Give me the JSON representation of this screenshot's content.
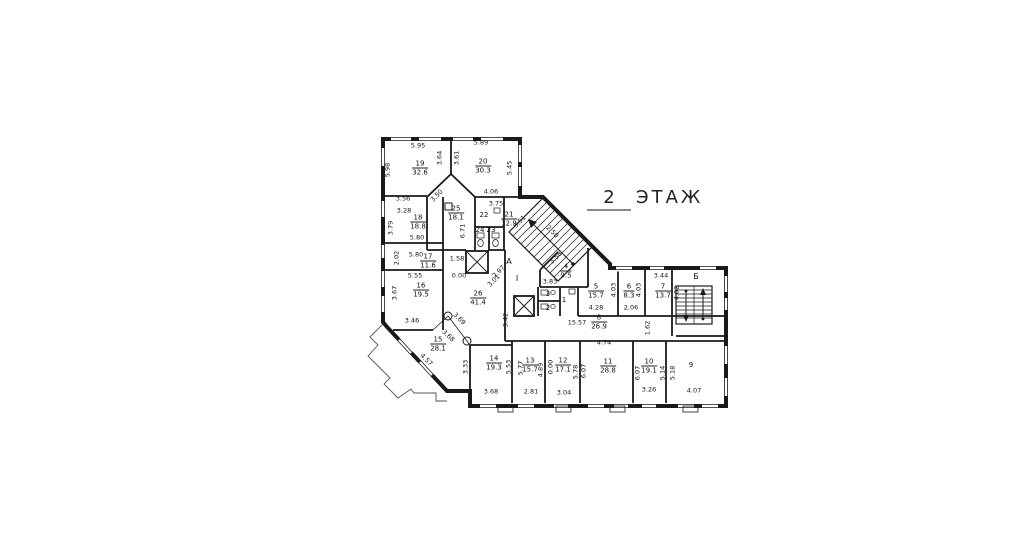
{
  "title": {
    "floor_number": "2",
    "floor_label": "ЭТАЖ"
  },
  "drawing": {
    "line_color": "#1a1a1a",
    "background": "#ffffff"
  },
  "rooms": [
    {
      "number": "19",
      "area": "32.6",
      "x": 420,
      "y": 168
    },
    {
      "number": "20",
      "area": "30.3",
      "x": 483,
      "y": 166
    },
    {
      "number": "18",
      "area": "18.8",
      "x": 418,
      "y": 222
    },
    {
      "number": "25",
      "area": "18.1",
      "x": 456,
      "y": 213
    },
    {
      "number": "22",
      "area": "",
      "x": 484,
      "y": 215
    },
    {
      "number": "21",
      "area": "12.9",
      "x": 509,
      "y": 219
    },
    {
      "number": "24",
      "area": "",
      "x": 480,
      "y": 230
    },
    {
      "number": "23",
      "area": "",
      "x": 491,
      "y": 230
    },
    {
      "number": "17",
      "area": "11.6",
      "x": 428,
      "y": 261
    },
    {
      "number": "16",
      "area": "19.5",
      "x": 421,
      "y": 290
    },
    {
      "number": "26",
      "area": "41.4",
      "x": 478,
      "y": 298
    },
    {
      "number": "15",
      "area": "28.1",
      "x": 438,
      "y": 344
    },
    {
      "number": "14",
      "area": "19.3",
      "x": 494,
      "y": 363
    },
    {
      "number": "13",
      "area": "15.7",
      "x": 530,
      "y": 365
    },
    {
      "number": "12",
      "area": "17.1",
      "x": 563,
      "y": 365
    },
    {
      "number": "11",
      "area": "28.8",
      "x": 608,
      "y": 366
    },
    {
      "number": "10",
      "area": "19.1",
      "x": 649,
      "y": 366
    },
    {
      "number": "9",
      "area": "",
      "x": 691,
      "y": 365
    },
    {
      "number": "8",
      "area": "26.9",
      "x": 599,
      "y": 322
    },
    {
      "number": "5",
      "area": "15.7",
      "x": 596,
      "y": 291
    },
    {
      "number": "6",
      "area": "8.3",
      "x": 629,
      "y": 291
    },
    {
      "number": "7",
      "area": "13.7",
      "x": 663,
      "y": 291
    },
    {
      "number": "4",
      "area": "9.5",
      "x": 566,
      "y": 271
    },
    {
      "number": "3",
      "area": "",
      "x": 548,
      "y": 294
    },
    {
      "number": "2",
      "area": "",
      "x": 548,
      "y": 308
    },
    {
      "number": "1",
      "area": "",
      "x": 564,
      "y": 300
    }
  ],
  "dimensions": [
    {
      "text": "5.95",
      "x": 418,
      "y": 146,
      "rot": 0
    },
    {
      "text": "5.89",
      "x": 481,
      "y": 143,
      "rot": 0
    },
    {
      "text": "5.98",
      "x": 388,
      "y": 170,
      "rot": -90
    },
    {
      "text": "3.64",
      "x": 440,
      "y": 158,
      "rot": -90
    },
    {
      "text": "3.61",
      "x": 457,
      "y": 158,
      "rot": -90
    },
    {
      "text": "5.45",
      "x": 510,
      "y": 168,
      "rot": -90
    },
    {
      "text": "3.56",
      "x": 403,
      "y": 199,
      "rot": 0
    },
    {
      "text": "3.28",
      "x": 404,
      "y": 211,
      "rot": 0
    },
    {
      "text": "3.50",
      "x": 437,
      "y": 196,
      "rot": -45
    },
    {
      "text": "4.06",
      "x": 491,
      "y": 192,
      "rot": 0
    },
    {
      "text": "3.75",
      "x": 496,
      "y": 204,
      "rot": 0
    },
    {
      "text": "3.79",
      "x": 391,
      "y": 228,
      "rot": -90
    },
    {
      "text": "5.80",
      "x": 417,
      "y": 238,
      "rot": 0
    },
    {
      "text": "5.80",
      "x": 416,
      "y": 255,
      "rot": 0
    },
    {
      "text": "2.02",
      "x": 397,
      "y": 258,
      "rot": -90
    },
    {
      "text": "1.58",
      "x": 457,
      "y": 259,
      "rot": 0
    },
    {
      "text": "0.00",
      "x": 459,
      "y": 276,
      "rot": 0
    },
    {
      "text": "5.55",
      "x": 415,
      "y": 276,
      "rot": 0
    },
    {
      "text": "3.67",
      "x": 395,
      "y": 293,
      "rot": -90
    },
    {
      "text": "6.71",
      "x": 463,
      "y": 231,
      "rot": -90
    },
    {
      "text": "3.51",
      "x": 520,
      "y": 222,
      "rot": -45
    },
    {
      "text": "2.50",
      "x": 552,
      "y": 232,
      "rot": 45
    },
    {
      "text": "3.58",
      "x": 556,
      "y": 258,
      "rot": -45
    },
    {
      "text": "2.97",
      "x": 499,
      "y": 272,
      "rot": -45
    },
    {
      "text": "3.01",
      "x": 494,
      "y": 281,
      "rot": -45
    },
    {
      "text": "3.83",
      "x": 550,
      "y": 282,
      "rot": 0
    },
    {
      "text": "3.44",
      "x": 661,
      "y": 276,
      "rot": 0
    },
    {
      "text": "4.03",
      "x": 614,
      "y": 290,
      "rot": -90
    },
    {
      "text": "4.03",
      "x": 639,
      "y": 290,
      "rot": -90
    },
    {
      "text": "4.02",
      "x": 677,
      "y": 293,
      "rot": -90
    },
    {
      "text": "4.28",
      "x": 596,
      "y": 308,
      "rot": 0
    },
    {
      "text": "2.06",
      "x": 631,
      "y": 308,
      "rot": 0
    },
    {
      "text": "15.57",
      "x": 577,
      "y": 323,
      "rot": 0
    },
    {
      "text": "4.74",
      "x": 604,
      "y": 343,
      "rot": 0
    },
    {
      "text": "1.62",
      "x": 648,
      "y": 328,
      "rot": -90
    },
    {
      "text": "3.42",
      "x": 506,
      "y": 320,
      "rot": -90
    },
    {
      "text": "3.46",
      "x": 412,
      "y": 321,
      "rot": 0
    },
    {
      "text": "3.69",
      "x": 459,
      "y": 319,
      "rot": 45
    },
    {
      "text": "3.68",
      "x": 448,
      "y": 336,
      "rot": 45
    },
    {
      "text": "4.57",
      "x": 426,
      "y": 360,
      "rot": 45
    },
    {
      "text": "3.33",
      "x": 466,
      "y": 367,
      "rot": -90
    },
    {
      "text": "5.53",
      "x": 509,
      "y": 367,
      "rot": -90
    },
    {
      "text": "5.77",
      "x": 521,
      "y": 368,
      "rot": -90
    },
    {
      "text": "4.89",
      "x": 541,
      "y": 370,
      "rot": -90
    },
    {
      "text": "0.00",
      "x": 551,
      "y": 367,
      "rot": -90
    },
    {
      "text": "5.78",
      "x": 576,
      "y": 372,
      "rot": -90
    },
    {
      "text": "6.07",
      "x": 584,
      "y": 371,
      "rot": -90
    },
    {
      "text": "6.07",
      "x": 638,
      "y": 373,
      "rot": -90
    },
    {
      "text": "5.14",
      "x": 663,
      "y": 373,
      "rot": -90
    },
    {
      "text": "5.18",
      "x": 673,
      "y": 373,
      "rot": -90
    },
    {
      "text": "3.68",
      "x": 491,
      "y": 392,
      "rot": 0
    },
    {
      "text": "2.81",
      "x": 531,
      "y": 392,
      "rot": 0
    },
    {
      "text": "3.04",
      "x": 564,
      "y": 393,
      "rot": 0
    },
    {
      "text": "3.26",
      "x": 649,
      "y": 390,
      "rot": 0
    },
    {
      "text": "4.07",
      "x": 694,
      "y": 391,
      "rot": 0
    }
  ],
  "markers": [
    {
      "text": "А",
      "x": 509,
      "y": 262
    },
    {
      "text": "I",
      "x": 517,
      "y": 279
    },
    {
      "text": "Б",
      "x": 696,
      "y": 277
    }
  ]
}
